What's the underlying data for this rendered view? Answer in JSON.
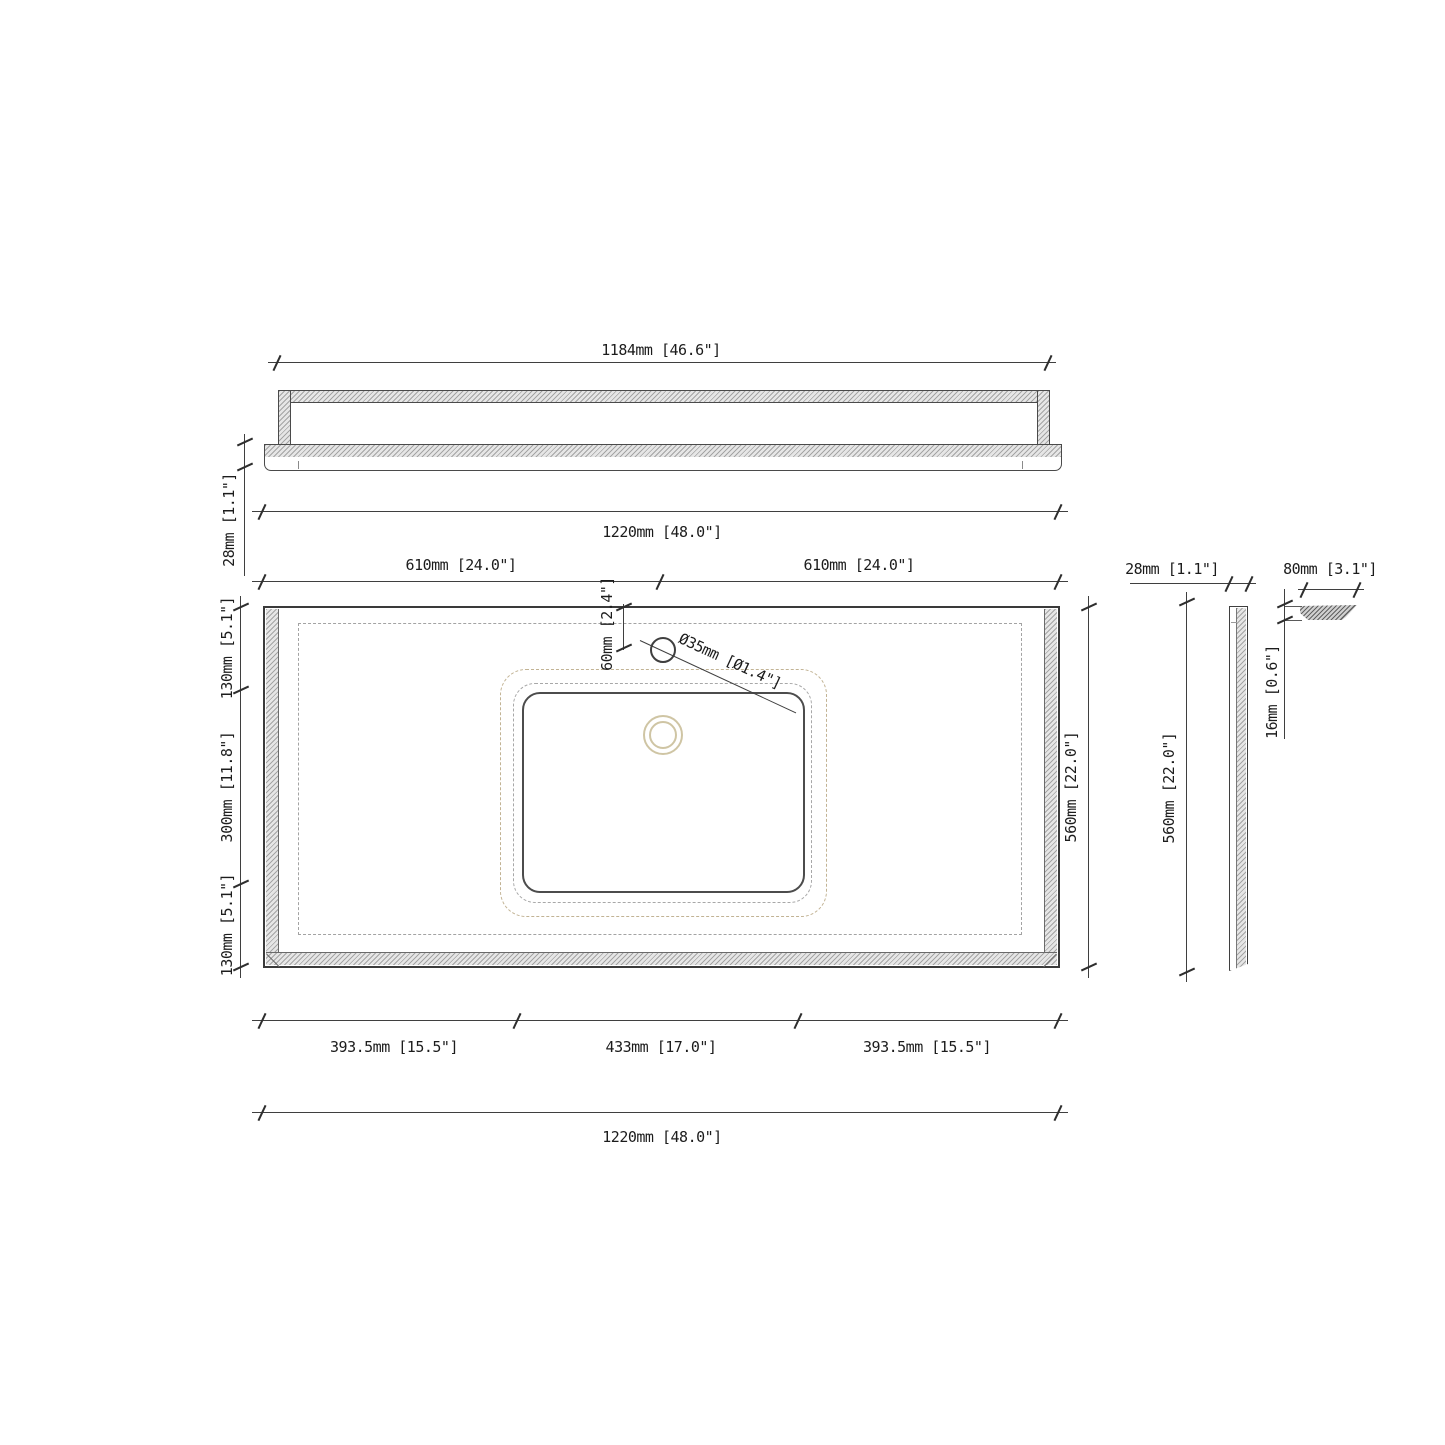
{
  "front_view": {
    "backsplash_width": "1184mm [46.6\"]",
    "thickness": "28mm [1.1\"]",
    "overall_width": "1220mm [48.0\"]"
  },
  "plan_view": {
    "half_width_left": "610mm [24.0\"]",
    "half_width_right": "610mm [24.0\"]",
    "faucet_offset": "60mm [2.4\"]",
    "faucet_hole_diameter": "Ø35mm [Ø1.4\"]",
    "edge_top": "130mm [5.1\"]",
    "sink_cutout_depth": "300mm [11.8\"]",
    "edge_bottom": "130mm [5.1\"]",
    "depth": "560mm [22.0\"]",
    "sink_left_offset": "393.5mm [15.5\"]",
    "sink_cutout_width": "433mm [17.0\"]",
    "sink_right_offset": "393.5mm [15.5\"]",
    "overall_width": "1220mm [48.0\"]"
  },
  "side_view": {
    "thickness": "28mm [1.1\"]",
    "depth": "560mm [22.0\"]"
  },
  "backsplash_profile": {
    "height": "80mm [3.1\"]",
    "thickness": "16mm [0.6\"]"
  },
  "colors": {
    "line": "#3f3f3f",
    "hatch_fill": "#e6e6e6",
    "dashed_gray": "#a3a3a3",
    "sink_tan": "#c2b394",
    "drain_tan": "#cfc5a4"
  }
}
